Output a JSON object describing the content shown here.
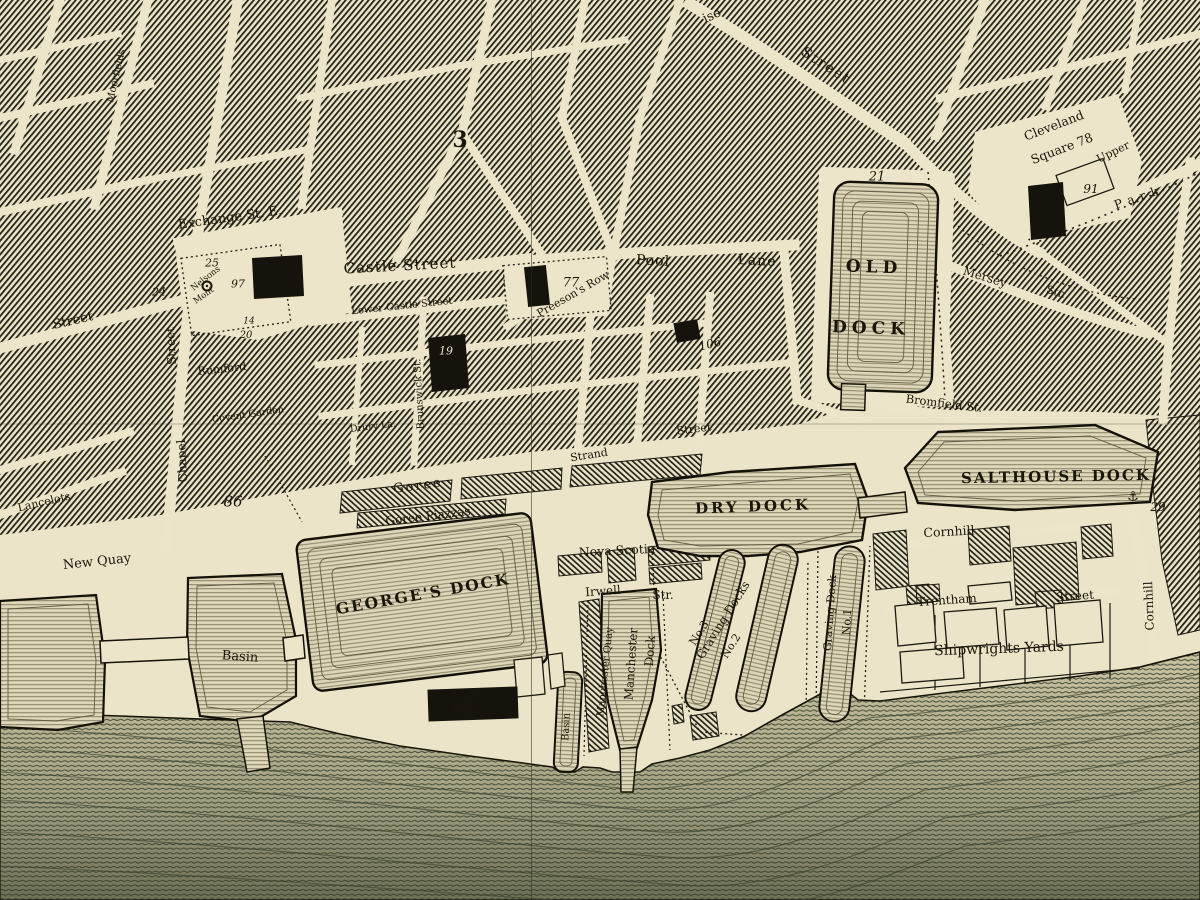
{
  "map": {
    "colors": {
      "paper": "#ece4c9",
      "ink": "#1a1509",
      "block_hatch": "#25221a",
      "dock_fill": "#ddd6b8",
      "dock_engraving": "#8a8266",
      "water_base": "#cac4a2",
      "water_line": "#49513a"
    },
    "labels": [
      {
        "name": "street-label-exchange-st-e",
        "text": "Exchange St. E.",
        "x": 230,
        "y": 218,
        "rot": -8,
        "size": 13
      },
      {
        "name": "street-label-castle-street",
        "text": "Castle Street",
        "x": 400,
        "y": 266,
        "rot": -3,
        "size": 15,
        "ls": 1
      },
      {
        "name": "street-label-lower-castle-street",
        "text": "Lower Castle Street",
        "x": 402,
        "y": 307,
        "rot": -6,
        "size": 10
      },
      {
        "name": "street-label-pool",
        "text": "Pool",
        "x": 653,
        "y": 261,
        "rot": 3,
        "size": 14,
        "ls": 1
      },
      {
        "name": "street-label-lane",
        "text": "Lane",
        "x": 757,
        "y": 261,
        "rot": 3,
        "size": 14,
        "ls": 1
      },
      {
        "name": "street-label-preesons-row",
        "text": "Preeson's Row",
        "x": 573,
        "y": 294,
        "rot": -30,
        "size": 11
      },
      {
        "name": "old-dock-label-line1",
        "text": "OLD",
        "x": 874,
        "y": 268,
        "rot": 2,
        "size": 17,
        "ls": 5,
        "bold": true
      },
      {
        "name": "old-dock-label-line2",
        "text": "DOCK",
        "x": 871,
        "y": 329,
        "rot": 2,
        "size": 17,
        "ls": 5,
        "bold": true
      },
      {
        "name": "plot-number-21",
        "text": "21",
        "x": 877,
        "y": 177,
        "italic": true,
        "size": 13
      },
      {
        "name": "cleveland-square-label-line1",
        "text": "Cleveland",
        "x": 1054,
        "y": 126,
        "rot": -21,
        "size": 12.5
      },
      {
        "name": "cleveland-square-label-line2",
        "text": "Square 78",
        "x": 1062,
        "y": 149,
        "rot": -21,
        "size": 12.5
      },
      {
        "name": "plot-number-91",
        "text": "91",
        "x": 1091,
        "y": 189,
        "italic": true,
        "size": 12
      },
      {
        "name": "street-label-upper",
        "text": "Upper",
        "x": 1113,
        "y": 152,
        "rot": -26,
        "size": 11
      },
      {
        "name": "street-label-park",
        "text": "Park",
        "x": 1139,
        "y": 197,
        "rot": -19,
        "size": 12,
        "ls": 6
      },
      {
        "name": "street-label-mersey",
        "text": "Mersey",
        "x": 985,
        "y": 277,
        "rot": 17,
        "size": 12
      },
      {
        "name": "street-label-mersey-str",
        "text": "Str.",
        "x": 1056,
        "y": 292,
        "rot": 17,
        "size": 11
      },
      {
        "name": "street-label-bromfield-st",
        "text": "Bromfield St.",
        "x": 944,
        "y": 404,
        "rot": 7,
        "size": 11.5
      },
      {
        "name": "salthouse-dock-label",
        "text": "SALTHOUSE DOCK",
        "x": 1056,
        "y": 477,
        "rot": -1,
        "size": 15,
        "ls": 2,
        "bold": true
      },
      {
        "name": "plot-number-29",
        "text": "29",
        "x": 1158,
        "y": 507,
        "italic": true,
        "size": 12
      },
      {
        "name": "street-label-cornhill",
        "text": "Cornhill",
        "x": 949,
        "y": 532,
        "rot": -3,
        "size": 12.5
      },
      {
        "name": "street-label-cornhill-vertical",
        "text": "Cornhill",
        "x": 1149,
        "y": 606,
        "rot": -92,
        "size": 12
      },
      {
        "name": "dry-dock-label",
        "text": "DRY DOCK",
        "x": 753,
        "y": 507,
        "rot": -2,
        "size": 15,
        "ls": 3,
        "bold": true
      },
      {
        "name": "street-label-nova-scotia",
        "text": "Nova Scotia",
        "x": 617,
        "y": 551,
        "rot": -3,
        "size": 12.5
      },
      {
        "name": "street-label-irwell",
        "text": "Irwell",
        "x": 603,
        "y": 591,
        "rot": -4,
        "size": 12
      },
      {
        "name": "street-label-irwell-str",
        "text": "Str.",
        "x": 663,
        "y": 595,
        "rot": 0,
        "size": 12
      },
      {
        "name": "manchester-quay-label",
        "text": "Manchester Quay",
        "x": 606,
        "y": 672,
        "rot": -84,
        "size": 10
      },
      {
        "name": "manchester-dock-label-line1",
        "text": "Manchester",
        "x": 631,
        "y": 664,
        "rot": -86,
        "size": 12
      },
      {
        "name": "manchester-dock-label-line2",
        "text": "Dock",
        "x": 650,
        "y": 651,
        "rot": -86,
        "size": 12
      },
      {
        "name": "graving-dock-no3-label",
        "text": "No.3",
        "x": 699,
        "y": 633,
        "rot": -58,
        "size": 11
      },
      {
        "name": "graving-docks-label",
        "text": "Graving Docks",
        "x": 723,
        "y": 620,
        "rot": -58,
        "size": 12
      },
      {
        "name": "graving-dock-no2-label",
        "text": "No.2",
        "x": 731,
        "y": 646,
        "rot": -58,
        "size": 11
      },
      {
        "name": "graving-dock-no1-label-line1",
        "text": "Graving Dock",
        "x": 830,
        "y": 613,
        "rot": -86,
        "size": 11
      },
      {
        "name": "graving-dock-no1-label-line2",
        "text": "No.1",
        "x": 847,
        "y": 622,
        "rot": -86,
        "size": 11
      },
      {
        "name": "street-label-trentham",
        "text": "Trentham",
        "x": 947,
        "y": 600,
        "rot": -4,
        "size": 12
      },
      {
        "name": "street-label-trentham-street",
        "text": "Street",
        "x": 1075,
        "y": 596,
        "rot": -4,
        "size": 12
      },
      {
        "name": "shipwrights-yards-label",
        "text": "Shipwrights Yards",
        "x": 999,
        "y": 649,
        "rot": -2,
        "size": 14
      },
      {
        "name": "new-quay-label",
        "text": "New Quay",
        "x": 97,
        "y": 562,
        "rot": -6,
        "size": 13
      },
      {
        "name": "basin-label",
        "text": "Basin",
        "x": 240,
        "y": 657,
        "rot": 4,
        "size": 13
      },
      {
        "name": "georges-dock-label",
        "text": "GEORGE'S DOCK",
        "x": 423,
        "y": 594,
        "rot": -10,
        "size": 15.5,
        "ls": 2,
        "bold": true
      },
      {
        "name": "goree-label",
        "text": "Goree",
        "x": 418,
        "y": 486,
        "rot": -8,
        "size": 13,
        "ls": 2
      },
      {
        "name": "goree-piazzas-label",
        "text": "Goree Piazzas",
        "x": 428,
        "y": 516,
        "rot": -7,
        "size": 12
      },
      {
        "name": "plot-number-62",
        "text": "62",
        "x": 462,
        "y": 708,
        "italic": true,
        "size": 15
      },
      {
        "name": "small-basin-label",
        "text": "Basin",
        "x": 567,
        "y": 727,
        "rot": -87,
        "size": 10
      },
      {
        "name": "street-label-street-west",
        "text": "Street",
        "x": 73,
        "y": 321,
        "rot": -13,
        "size": 13
      },
      {
        "name": "street-label-chapel",
        "text": "Chapel",
        "x": 182,
        "y": 461,
        "rot": -93,
        "size": 12
      },
      {
        "name": "street-label-chapel-street",
        "text": "Street",
        "x": 171,
        "y": 346,
        "rot": -93,
        "size": 12
      },
      {
        "name": "plot-number-24",
        "text": "24",
        "x": 159,
        "y": 292,
        "italic": true,
        "size": 11
      },
      {
        "name": "plot-number-25",
        "text": "25",
        "x": 212,
        "y": 263,
        "italic": true,
        "size": 11
      },
      {
        "name": "nelsons-monument-label-line1",
        "text": "Nelsons",
        "x": 206,
        "y": 279,
        "rot": -38,
        "size": 8.5
      },
      {
        "name": "plot-number-97",
        "text": "97",
        "x": 238,
        "y": 284,
        "italic": true,
        "size": 11
      },
      {
        "name": "nelsons-monument-label-line2",
        "text": "Mont",
        "x": 204,
        "y": 296,
        "rot": -35,
        "size": 8.5
      },
      {
        "name": "plot-number-14",
        "text": "14",
        "x": 249,
        "y": 322,
        "italic": true,
        "size": 9
      },
      {
        "name": "plot-number-20",
        "text": "20",
        "x": 246,
        "y": 336,
        "italic": true,
        "size": 10
      },
      {
        "name": "street-label-rumford",
        "text": "Rumford",
        "x": 222,
        "y": 369,
        "rot": -6,
        "size": 11
      },
      {
        "name": "plot-number-86",
        "text": "86",
        "x": 233,
        "y": 502,
        "italic": true,
        "size": 15
      },
      {
        "name": "plot-number-19",
        "text": "19",
        "x": 446,
        "y": 351,
        "italic": true,
        "size": 11,
        "color": "#eee6cd"
      },
      {
        "name": "plot-number-77",
        "text": "77",
        "x": 571,
        "y": 283,
        "italic": true,
        "size": 13
      },
      {
        "name": "plot-number-106",
        "text": "106",
        "x": 710,
        "y": 344,
        "rot": -14,
        "italic": true,
        "size": 12
      },
      {
        "name": "district-number-3",
        "text": "3",
        "x": 460,
        "y": 140,
        "size": 22,
        "bold": true
      },
      {
        "name": "street-label-paradise-partial",
        "text": "ise",
        "x": 712,
        "y": 16,
        "rot": -25,
        "size": 13
      },
      {
        "name": "street-label-paradise-street",
        "text": "Street",
        "x": 826,
        "y": 66,
        "rot": 33,
        "size": 14,
        "ls": 2
      },
      {
        "name": "street-label-strand",
        "text": "Strand",
        "x": 589,
        "y": 455,
        "rot": -9,
        "size": 11
      },
      {
        "name": "street-label-strand-street",
        "text": "Street",
        "x": 694,
        "y": 429,
        "rot": -7,
        "size": 11
      },
      {
        "name": "street-label-lancelots",
        "text": "Lancelots",
        "x": 44,
        "y": 502,
        "rot": -13,
        "size": 11
      },
      {
        "name": "street-label-covent-garden",
        "text": "Covent Garden",
        "x": 248,
        "y": 415,
        "rot": -8,
        "size": 9.5
      },
      {
        "name": "street-label-drury-la",
        "text": "Drury La.",
        "x": 373,
        "y": 427,
        "rot": -7,
        "size": 9.5
      },
      {
        "name": "street-label-brunswick-st",
        "text": "Brunswick St.",
        "x": 420,
        "y": 394,
        "rot": -93,
        "size": 10
      },
      {
        "name": "street-label-moorfields",
        "text": "Moorfields",
        "x": 117,
        "y": 76,
        "rot": -77,
        "size": 10
      },
      {
        "name": "anchor-icon",
        "text": "⚓",
        "x": 1133,
        "y": 497,
        "size": 13,
        "font": "sans"
      }
    ]
  }
}
